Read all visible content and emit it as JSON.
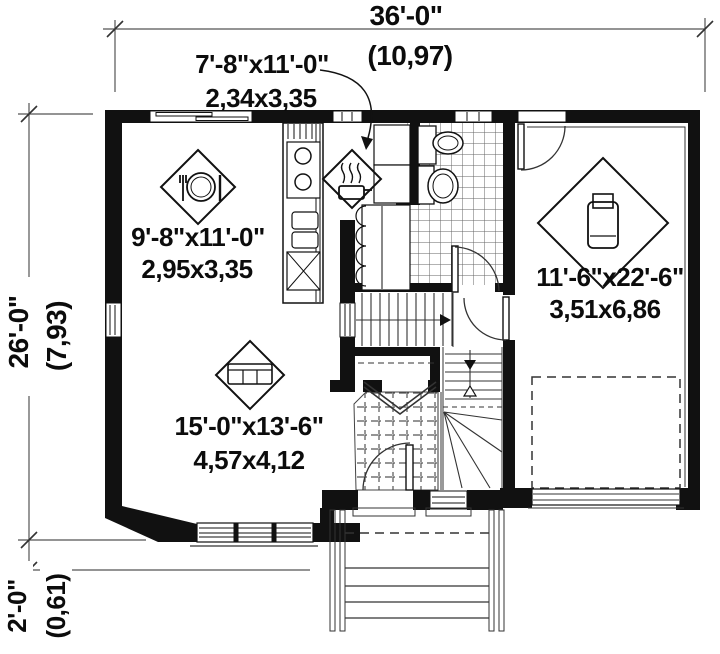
{
  "title": "house-first-floor-plan",
  "dims": {
    "width_ft": "36'-0\"",
    "width_m": "(10,97)",
    "depth_ft": "26'-0\"",
    "depth_m": "(7,93)",
    "porch_ft": "2'-0\"",
    "porch_m": "(0,61)"
  },
  "rooms": {
    "kitchen": {
      "imperial": "7'-8\"x11'-0\"",
      "metric": "2,34x3,35"
    },
    "dining": {
      "imperial": "9'-8\"x11'-0\"",
      "metric": "2,95x3,35"
    },
    "garage": {
      "imperial": "11'-6\"x22'-6\"",
      "metric": "3,51x6,86"
    },
    "living": {
      "imperial": "15'-0\"x13'-6\"",
      "metric": "4,57x4,12"
    }
  },
  "icons": {
    "dining": "dining-table-icon",
    "kitchen": "cooking-pot-icon",
    "living": "sofa-icon",
    "garage": "car-icon"
  },
  "colors": {
    "wall": "#111111",
    "line": "#333333",
    "dim_line": "#555555",
    "tile_line": "#666666",
    "background": "#ffffff"
  }
}
